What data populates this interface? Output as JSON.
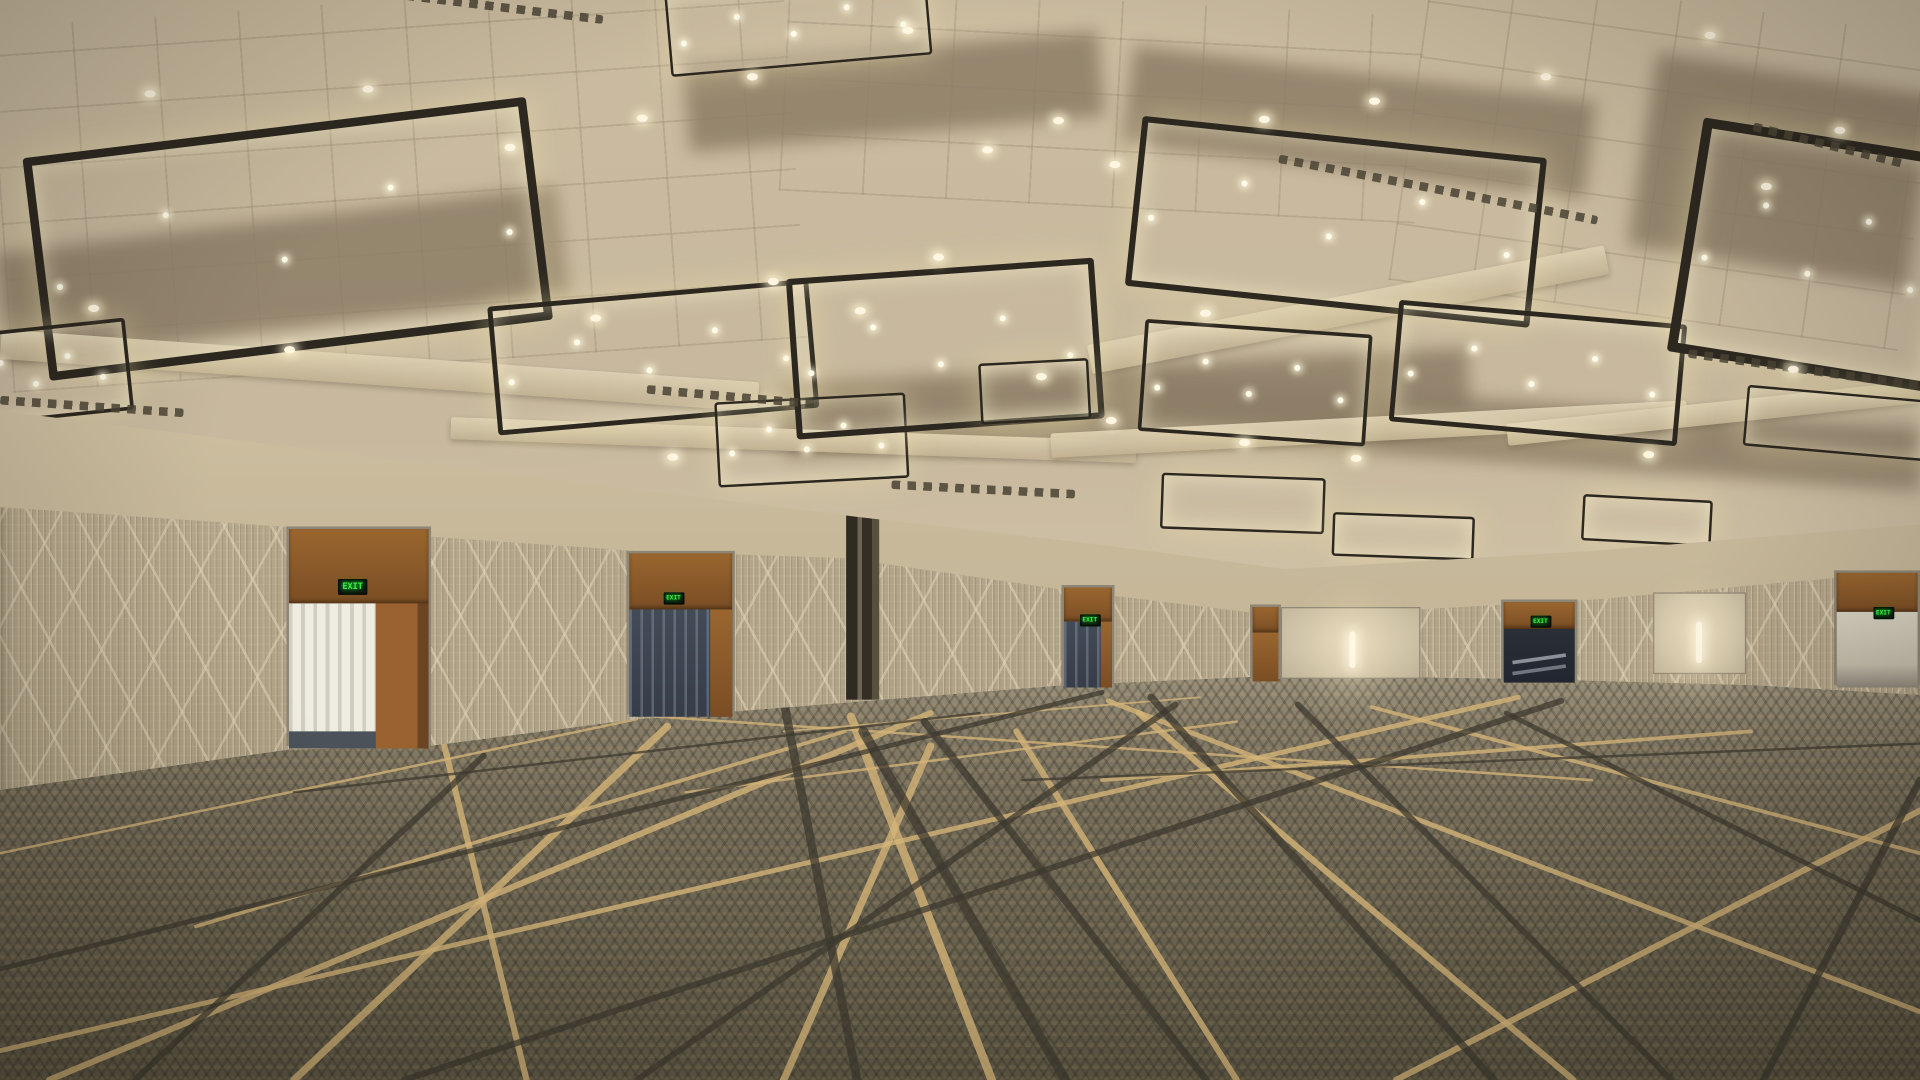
{
  "scene": {
    "description": "Empty convention-center ballroom, 3D architectural rendering: coffered ceiling with back-lit decorative lattice light panels, patterned wall coverings, wood exit doors with illuminated EXIT signs, and a geometric line-pattern carpet.",
    "exit_sign_label": "EXIT",
    "palette": {
      "ceiling_base": "#c7b89e",
      "ceiling_glow": "#efe6cf",
      "fixture_glow": "#eee3b2",
      "fixture_frame": "#2c2820",
      "wall_upper": "#d9cbae",
      "wallpaper": "#b3a58a",
      "door_wood": "#8f5c2d",
      "exit_green": "#35f03c",
      "carpet_base": "#6e6753",
      "carpet_gold": "#d4b478",
      "carpet_dark": "#3c382e",
      "sconce": "#fff7e3"
    },
    "ceiling": {
      "fixtures": [
        {
          "x": 28,
          "y": 104,
          "w": 400,
          "h": 170,
          "r": -7
        },
        {
          "x": -40,
          "y": 268,
          "w": 140,
          "h": 70,
          "r": -6
        },
        {
          "x": 545,
          "y": -14,
          "w": 210,
          "h": 64,
          "r": -5
        },
        {
          "x": 402,
          "y": 240,
          "w": 255,
          "h": 98,
          "r": -5
        },
        {
          "x": 585,
          "y": 326,
          "w": 152,
          "h": 66,
          "r": -3
        },
        {
          "x": 646,
          "y": 220,
          "w": 242,
          "h": 122,
          "r": -4
        },
        {
          "x": 925,
          "y": 112,
          "w": 322,
          "h": 130,
          "r": 6
        },
        {
          "x": 932,
          "y": 268,
          "w": 180,
          "h": 86,
          "r": 4
        },
        {
          "x": 1138,
          "y": 256,
          "w": 228,
          "h": 92,
          "r": 5
        },
        {
          "x": 1375,
          "y": 112,
          "w": 200,
          "h": 178,
          "r": 9
        },
        {
          "x": 1425,
          "y": 322,
          "w": 145,
          "h": 46,
          "r": 5
        },
        {
          "x": 800,
          "y": 296,
          "w": 86,
          "h": 46,
          "r": -3
        },
        {
          "x": 948,
          "y": 390,
          "w": 130,
          "h": 42,
          "r": 2
        },
        {
          "x": 1088,
          "y": 422,
          "w": 112,
          "h": 32,
          "r": 2
        },
        {
          "x": 1292,
          "y": 408,
          "w": 102,
          "h": 34,
          "r": 3
        }
      ],
      "downlights": [
        [
          118,
          74
        ],
        [
          296,
          70
        ],
        [
          412,
          118
        ],
        [
          520,
          94
        ],
        [
          610,
          60
        ],
        [
          737,
          22
        ],
        [
          802,
          120
        ],
        [
          860,
          96
        ],
        [
          906,
          132
        ],
        [
          627,
          228
        ],
        [
          698,
          252
        ],
        [
          762,
          208
        ],
        [
          980,
          254
        ],
        [
          1028,
          95
        ],
        [
          1118,
          80
        ],
        [
          1258,
          60
        ],
        [
          1392,
          26
        ],
        [
          1438,
          150
        ],
        [
          1498,
          104
        ],
        [
          903,
          342
        ],
        [
          846,
          306
        ],
        [
          1012,
          360
        ],
        [
          1103,
          373
        ],
        [
          482,
          258
        ],
        [
          232,
          284
        ],
        [
          72,
          250
        ],
        [
          545,
          372
        ],
        [
          1342,
          370
        ],
        [
          1460,
          300
        ]
      ],
      "vents": [
        {
          "x": 318,
          "y": 2,
          "len": 175,
          "r": 7
        },
        {
          "x": 0,
          "y": 330,
          "len": 150,
          "r": 4
        },
        {
          "x": 1042,
          "y": 152,
          "len": 265,
          "r": 11
        },
        {
          "x": 528,
          "y": 322,
          "len": 140,
          "r": 5
        },
        {
          "x": 728,
          "y": 398,
          "len": 150,
          "r": 3
        },
        {
          "x": 1378,
          "y": 300,
          "len": 195,
          "r": 8
        },
        {
          "x": 1430,
          "y": 116,
          "len": 130,
          "r": 14
        }
      ],
      "beams": [
        {
          "x": 0,
          "y": 292,
          "len": 620,
          "h": 24,
          "r": 4
        },
        {
          "x": 368,
          "y": 352,
          "len": 560,
          "h": 18,
          "r": 2
        },
        {
          "x": 886,
          "y": 242,
          "len": 430,
          "h": 24,
          "r": -11
        },
        {
          "x": 858,
          "y": 342,
          "len": 520,
          "h": 20,
          "r": -3
        },
        {
          "x": 1230,
          "y": 330,
          "len": 340,
          "h": 18,
          "r": -6
        }
      ],
      "recesses": [
        {
          "x": 0,
          "y": 180,
          "w": 460,
          "h": 90,
          "r": -7
        },
        {
          "x": 560,
          "y": 40,
          "w": 340,
          "h": 70,
          "r": -5
        },
        {
          "x": 920,
          "y": 60,
          "w": 380,
          "h": 80,
          "r": 7
        },
        {
          "x": 1340,
          "y": 60,
          "w": 230,
          "h": 160,
          "r": 9
        },
        {
          "x": 640,
          "y": 300,
          "w": 560,
          "h": 60,
          "r": -3
        },
        {
          "x": 930,
          "y": 330,
          "w": 640,
          "h": 50,
          "r": 4
        }
      ],
      "tilegrids": [
        {
          "x": 0,
          "y": 0,
          "w": 650,
          "h": 300,
          "r": -4
        },
        {
          "x": 640,
          "y": 0,
          "w": 520,
          "h": 170,
          "r": 3
        },
        {
          "x": 1150,
          "y": 0,
          "w": 420,
          "h": 260,
          "r": 8
        }
      ]
    },
    "wall": {
      "doors": [
        {
          "kind": "open-bright",
          "x": 234,
          "top": 432,
          "w": 118,
          "bottom": 612,
          "exit": {
            "x": 287,
            "y": 480
          }
        },
        {
          "kind": "glass",
          "x": 512,
          "top": 452,
          "w": 88,
          "bottom": 586,
          "exit": {
            "x": 549,
            "y": 490
          }
        },
        {
          "kind": "column",
          "x": 691,
          "top": 410,
          "w": 27,
          "bottom": 574
        },
        {
          "kind": "glass-sm",
          "x": 867,
          "top": 480,
          "w": 43,
          "bottom": 562,
          "exit": {
            "x": 889,
            "y": 508
          }
        },
        {
          "kind": "wood-sm",
          "x": 1021,
          "top": 496,
          "w": 25,
          "bottom": 557
        },
        {
          "kind": "panel",
          "x": 1046,
          "top": 498,
          "w": 114,
          "bottom": 557
        },
        {
          "kind": "escalator",
          "x": 1226,
          "top": 492,
          "w": 62,
          "bottom": 558,
          "exit": {
            "x": 1257,
            "y": 509
          }
        },
        {
          "kind": "panel",
          "x": 1350,
          "top": 486,
          "w": 76,
          "bottom": 553
        },
        {
          "kind": "open-dim",
          "x": 1498,
          "top": 468,
          "w": 70,
          "bottom": 562,
          "exit": {
            "x": 1537,
            "y": 502
          }
        }
      ],
      "sconces": [
        {
          "x": 1102,
          "y": 518,
          "h": 30
        },
        {
          "x": 1385,
          "y": 510,
          "h": 34
        }
      ]
    },
    "carpet": {
      "lines": [
        {
          "x1": 0,
          "y1": 862,
          "x2": 1240,
          "y2": 572,
          "c": "gold",
          "w": 4
        },
        {
          "x1": 40,
          "y1": 886,
          "x2": 760,
          "y2": 585,
          "c": "gold",
          "w": 5
        },
        {
          "x1": 240,
          "y1": 886,
          "x2": 545,
          "y2": 596,
          "c": "gold",
          "w": 6
        },
        {
          "x1": 430,
          "y1": 886,
          "x2": 360,
          "y2": 600,
          "c": "gold",
          "w": 5
        },
        {
          "x1": 640,
          "y1": 886,
          "x2": 760,
          "y2": 612,
          "c": "gold",
          "w": 6
        },
        {
          "x1": 810,
          "y1": 886,
          "x2": 695,
          "y2": 588,
          "c": "gold",
          "w": 7
        },
        {
          "x1": 1010,
          "y1": 886,
          "x2": 830,
          "y2": 600,
          "c": "gold",
          "w": 5
        },
        {
          "x1": 1285,
          "y1": 886,
          "x2": 930,
          "y2": 585,
          "c": "gold",
          "w": 5
        },
        {
          "x1": 1568,
          "y1": 830,
          "x2": 905,
          "y2": 575,
          "c": "gold",
          "w": 4
        },
        {
          "x1": 1568,
          "y1": 700,
          "x2": 1120,
          "y2": 580,
          "c": "gold",
          "w": 3
        },
        {
          "x1": 1300,
          "y1": 640,
          "x2": 420,
          "y2": 580,
          "c": "gold",
          "w": 2
        },
        {
          "x1": 0,
          "y1": 700,
          "x2": 520,
          "y2": 590,
          "c": "gold",
          "w": 2
        },
        {
          "x1": 160,
          "y1": 760,
          "x2": 690,
          "y2": 600,
          "c": "gold",
          "w": 3
        },
        {
          "x1": 900,
          "y1": 640,
          "x2": 1430,
          "y2": 600,
          "c": "gold",
          "w": 3
        },
        {
          "x1": 1140,
          "y1": 886,
          "x2": 1568,
          "y2": 665,
          "c": "gold",
          "w": 5
        },
        {
          "x1": 0,
          "y1": 640,
          "x2": 230,
          "y2": 600,
          "c": "gold",
          "w": 2
        },
        {
          "x1": 560,
          "y1": 650,
          "x2": 1010,
          "y2": 592,
          "c": "gold",
          "w": 2
        },
        {
          "x1": 640,
          "y1": 600,
          "x2": 980,
          "y2": 572,
          "c": "gold",
          "w": 1.5
        },
        {
          "x1": 700,
          "y1": 886,
          "x2": 640,
          "y2": 575,
          "c": "dark",
          "w": 7
        },
        {
          "x1": 870,
          "y1": 886,
          "x2": 705,
          "y2": 600,
          "c": "dark",
          "w": 8
        },
        {
          "x1": 985,
          "y1": 886,
          "x2": 755,
          "y2": 592,
          "c": "dark",
          "w": 6
        },
        {
          "x1": 520,
          "y1": 886,
          "x2": 960,
          "y2": 578,
          "c": "dark",
          "w": 5
        },
        {
          "x1": 1220,
          "y1": 886,
          "x2": 940,
          "y2": 572,
          "c": "dark",
          "w": 6
        },
        {
          "x1": 1440,
          "y1": 886,
          "x2": 1568,
          "y2": 640,
          "c": "dark",
          "w": 6
        },
        {
          "x1": 1365,
          "y1": 886,
          "x2": 1060,
          "y2": 578,
          "c": "dark",
          "w": 5
        },
        {
          "x1": 0,
          "y1": 795,
          "x2": 900,
          "y2": 568,
          "c": "dark",
          "w": 4
        },
        {
          "x1": 330,
          "y1": 886,
          "x2": 1275,
          "y2": 575,
          "c": "dark",
          "w": 5
        },
        {
          "x1": 110,
          "y1": 886,
          "x2": 395,
          "y2": 620,
          "c": "dark",
          "w": 5
        },
        {
          "x1": 1568,
          "y1": 755,
          "x2": 1230,
          "y2": 585,
          "c": "dark",
          "w": 4
        },
        {
          "x1": 835,
          "y1": 640,
          "x2": 1568,
          "y2": 610,
          "c": "dark",
          "w": 2
        },
        {
          "x1": 240,
          "y1": 650,
          "x2": 800,
          "y2": 585,
          "c": "dark",
          "w": 2
        }
      ]
    }
  }
}
